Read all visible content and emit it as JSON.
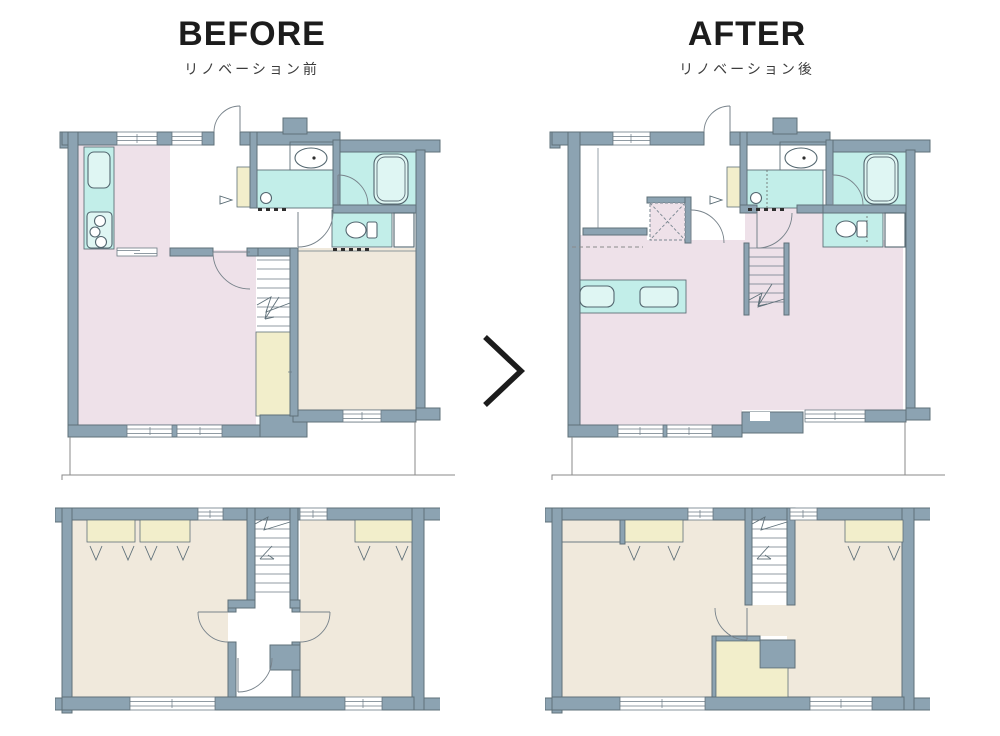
{
  "comparison": {
    "before": {
      "title": "BEFORE",
      "subtitle": "リノベーション前"
    },
    "after": {
      "title": "AFTER",
      "subtitle": "リノベーション後"
    },
    "arrow": "chevron-right"
  },
  "palette": {
    "wall": "#8CA3B2",
    "wall_line": "#5F7079",
    "room_pink": "#EEE1E9",
    "room_beige": "#F0E9DC",
    "closet_yellow": "#F2EECB",
    "fixture_cyan": "#C2EEE9",
    "fixture_light": "#DFF6F3",
    "balcony_line": "#8A8A8A",
    "title_text": "#1C1C1C",
    "subtitle_text": "#3C3C3C",
    "page_bg": "#FFFFFF"
  },
  "plans": {
    "before_upper": "before-renovation-upper-floor-plan",
    "before_lower": "before-renovation-lower-floor-plan",
    "after_upper": "after-renovation-upper-floor-plan",
    "after_lower": "after-renovation-lower-floor-plan"
  }
}
